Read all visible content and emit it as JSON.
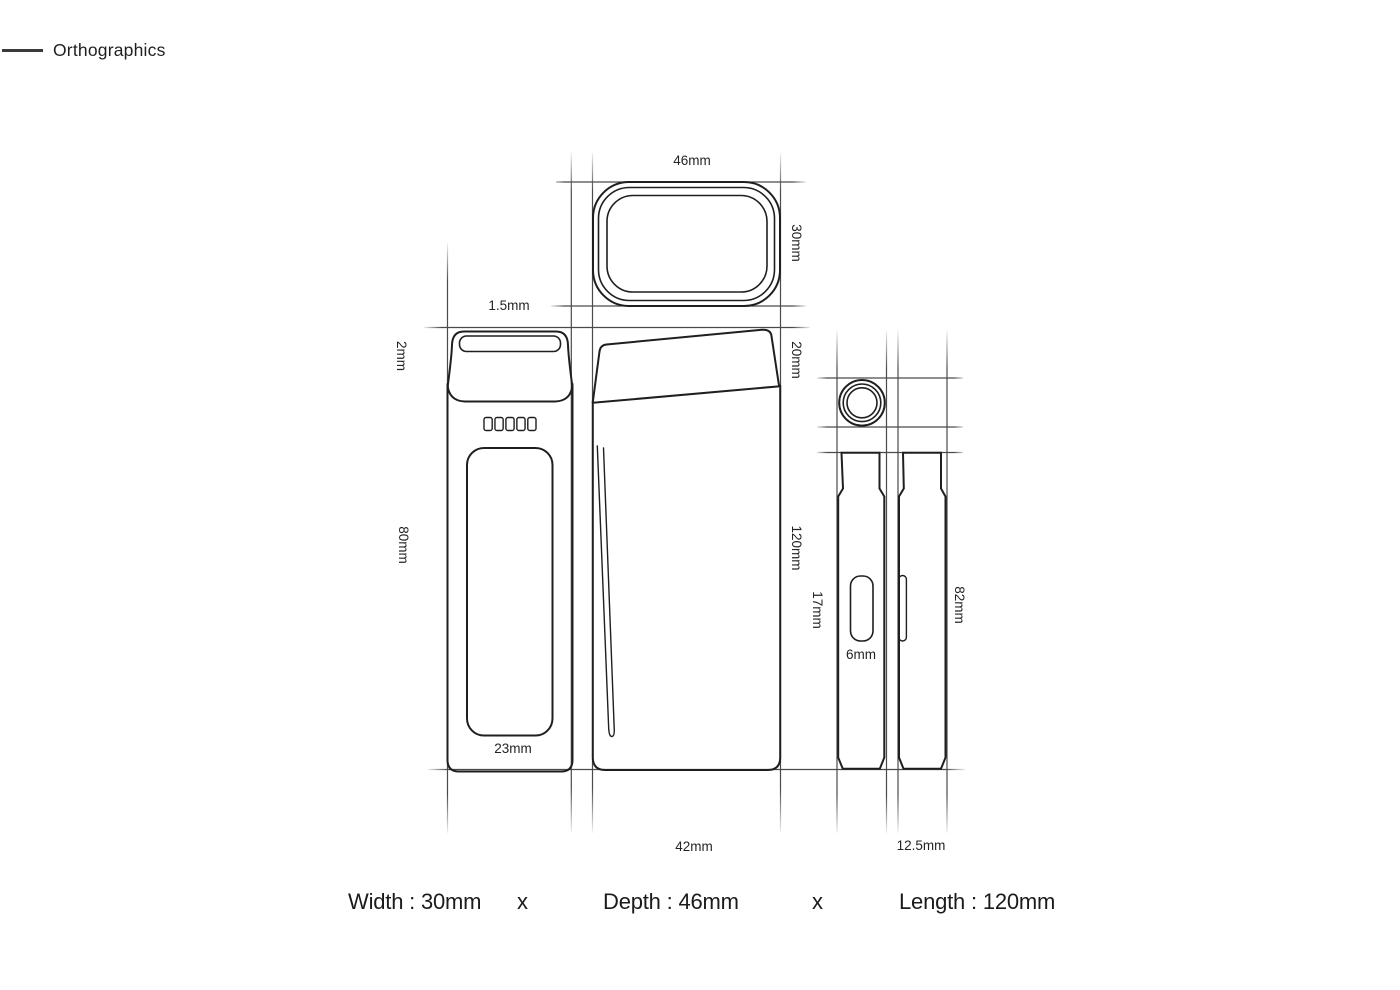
{
  "header": {
    "title": "Orthographics"
  },
  "dimensions": {
    "top_width": "46mm",
    "top_depth": "30mm",
    "cap_lip": "1.5mm",
    "cap_top": "2mm",
    "front_body": "80mm",
    "window_width": "23mm",
    "mouth_section": "20mm",
    "length": "120mm",
    "base_depth": "42mm",
    "button_length": "17mm",
    "button_width": "6mm",
    "side_body": "82mm",
    "half_width": "12.5mm"
  },
  "summary": {
    "width": "Width : 30mm",
    "separator_1": "x",
    "depth": "Depth : 46mm",
    "separator_2": "x",
    "length": "Length : 120mm"
  },
  "colors": {
    "line": "#1f1f1f",
    "construction": "#4a4a4a",
    "text": "#242424"
  }
}
